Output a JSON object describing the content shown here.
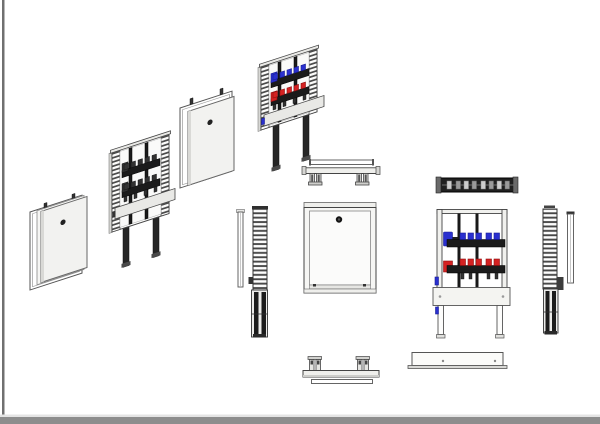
{
  "page": {
    "background": "#ffffff"
  },
  "colors": {
    "bg": "#ffffff",
    "line": "#444444",
    "panel": "#f2f2f0",
    "panel_shade": "#d9d9d6",
    "metal": "#e9e9e6",
    "dark": "#1b1b1b",
    "dark_mid": "#323232",
    "blue": "#2a30cf",
    "blue_dark": "#181d94",
    "red": "#d42222",
    "red_dark": "#8f1010",
    "border_left": "#707070",
    "footer": "#8d8d8d",
    "footer_light": "#e4e4e4"
  },
  "drawing": {
    "subject": "Flush-mounted manifold cabinet: exploded isometric sequence and orthographic projection views",
    "manifold": {
      "top_row_color": "blue",
      "top_row_valves": 5,
      "bottom_row_color": "red",
      "bottom_row_valves": 5,
      "vertical_pipes": 2
    },
    "views": [
      {
        "label": "Exploded isometric - door and outer frame"
      },
      {
        "label": "Exploded isometric - cabinet frame with manifold"
      },
      {
        "label": "Exploded isometric - frame with door panel"
      },
      {
        "label": "Assembled isometric - cabinet with colored manifold"
      },
      {
        "label": "Side view - door and frame rail"
      },
      {
        "label": "Top view - frame with legs"
      },
      {
        "label": "Front view - cabinet closed"
      },
      {
        "label": "Top view - manifold"
      },
      {
        "label": "Front view - cabinet open with manifold"
      },
      {
        "label": "Side view - frame rail and door"
      },
      {
        "label": "Bottom view - frame with legs"
      },
      {
        "label": "Bottom view - cabinet body"
      }
    ]
  }
}
